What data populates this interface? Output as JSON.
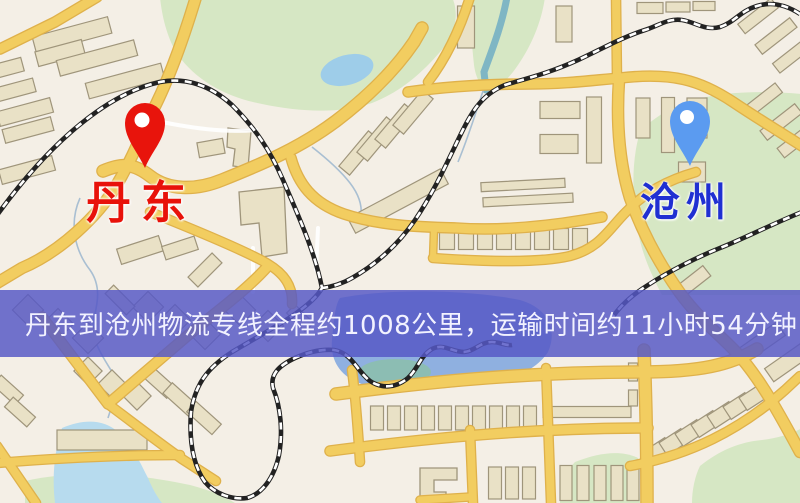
{
  "map": {
    "origin": {
      "name": "丹东",
      "pin_color": "#e8140c",
      "label_color": "#e8120a"
    },
    "destination": {
      "name": "沧州",
      "pin_color": "#5b9bf0",
      "label_color": "#2030d2"
    },
    "banner": {
      "text": "丹东到沧州物流专线全程约1008公里，运输时间约11小时54分钟.",
      "bg_color": "rgba(86,88,198,0.84)",
      "text_color": "#f2f2ff"
    },
    "route": {
      "distance_km": "1008",
      "duration_hours": "11",
      "duration_minutes": "54"
    },
    "palette": {
      "background": "#f4efe6",
      "road_fill": "#f2cd60",
      "road_casing": "#dfb14b",
      "building_fill": "#e9e1c6",
      "building_stroke": "#9f957b",
      "park_green": "#d6e7c4",
      "water_blue": "#9ecde9",
      "railway": "#222222"
    }
  }
}
